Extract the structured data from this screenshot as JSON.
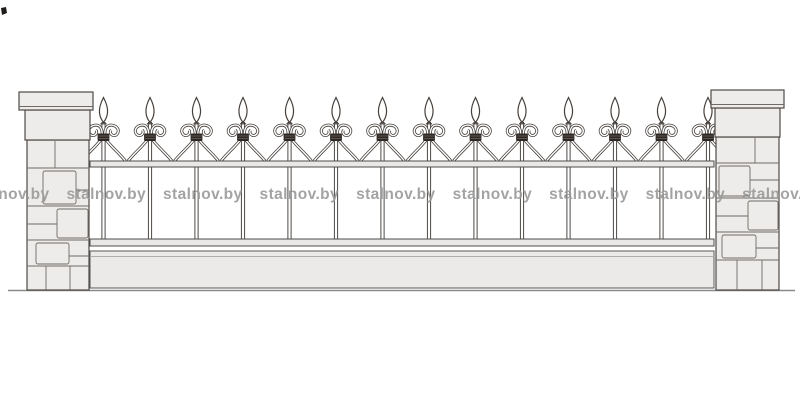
{
  "scene": {
    "title": "Wrought-iron fence elevation drawing",
    "description": "Front elevation of a decorative metal fence section mounted between two stone block pillars on a base plinth"
  },
  "watermark": {
    "text": "stalnov.by",
    "count": 9,
    "color": "#9a9a9a"
  },
  "fence": {
    "finial_count": 14,
    "finial_style": "spear-point",
    "ornament_style": "paired C-scrolls bound by dark collar at each picket",
    "rail_count": 2,
    "has_base_plinth": true,
    "pillar_count": 2,
    "pillar_material": "stone blocks with cap"
  },
  "colors": {
    "background": "#ffffff",
    "line": "#46403c",
    "stone_fill": "#edecea",
    "rail_fill": "#e9e8e6",
    "collar": "#2d2825",
    "ground_line": "#8a8a8a"
  }
}
